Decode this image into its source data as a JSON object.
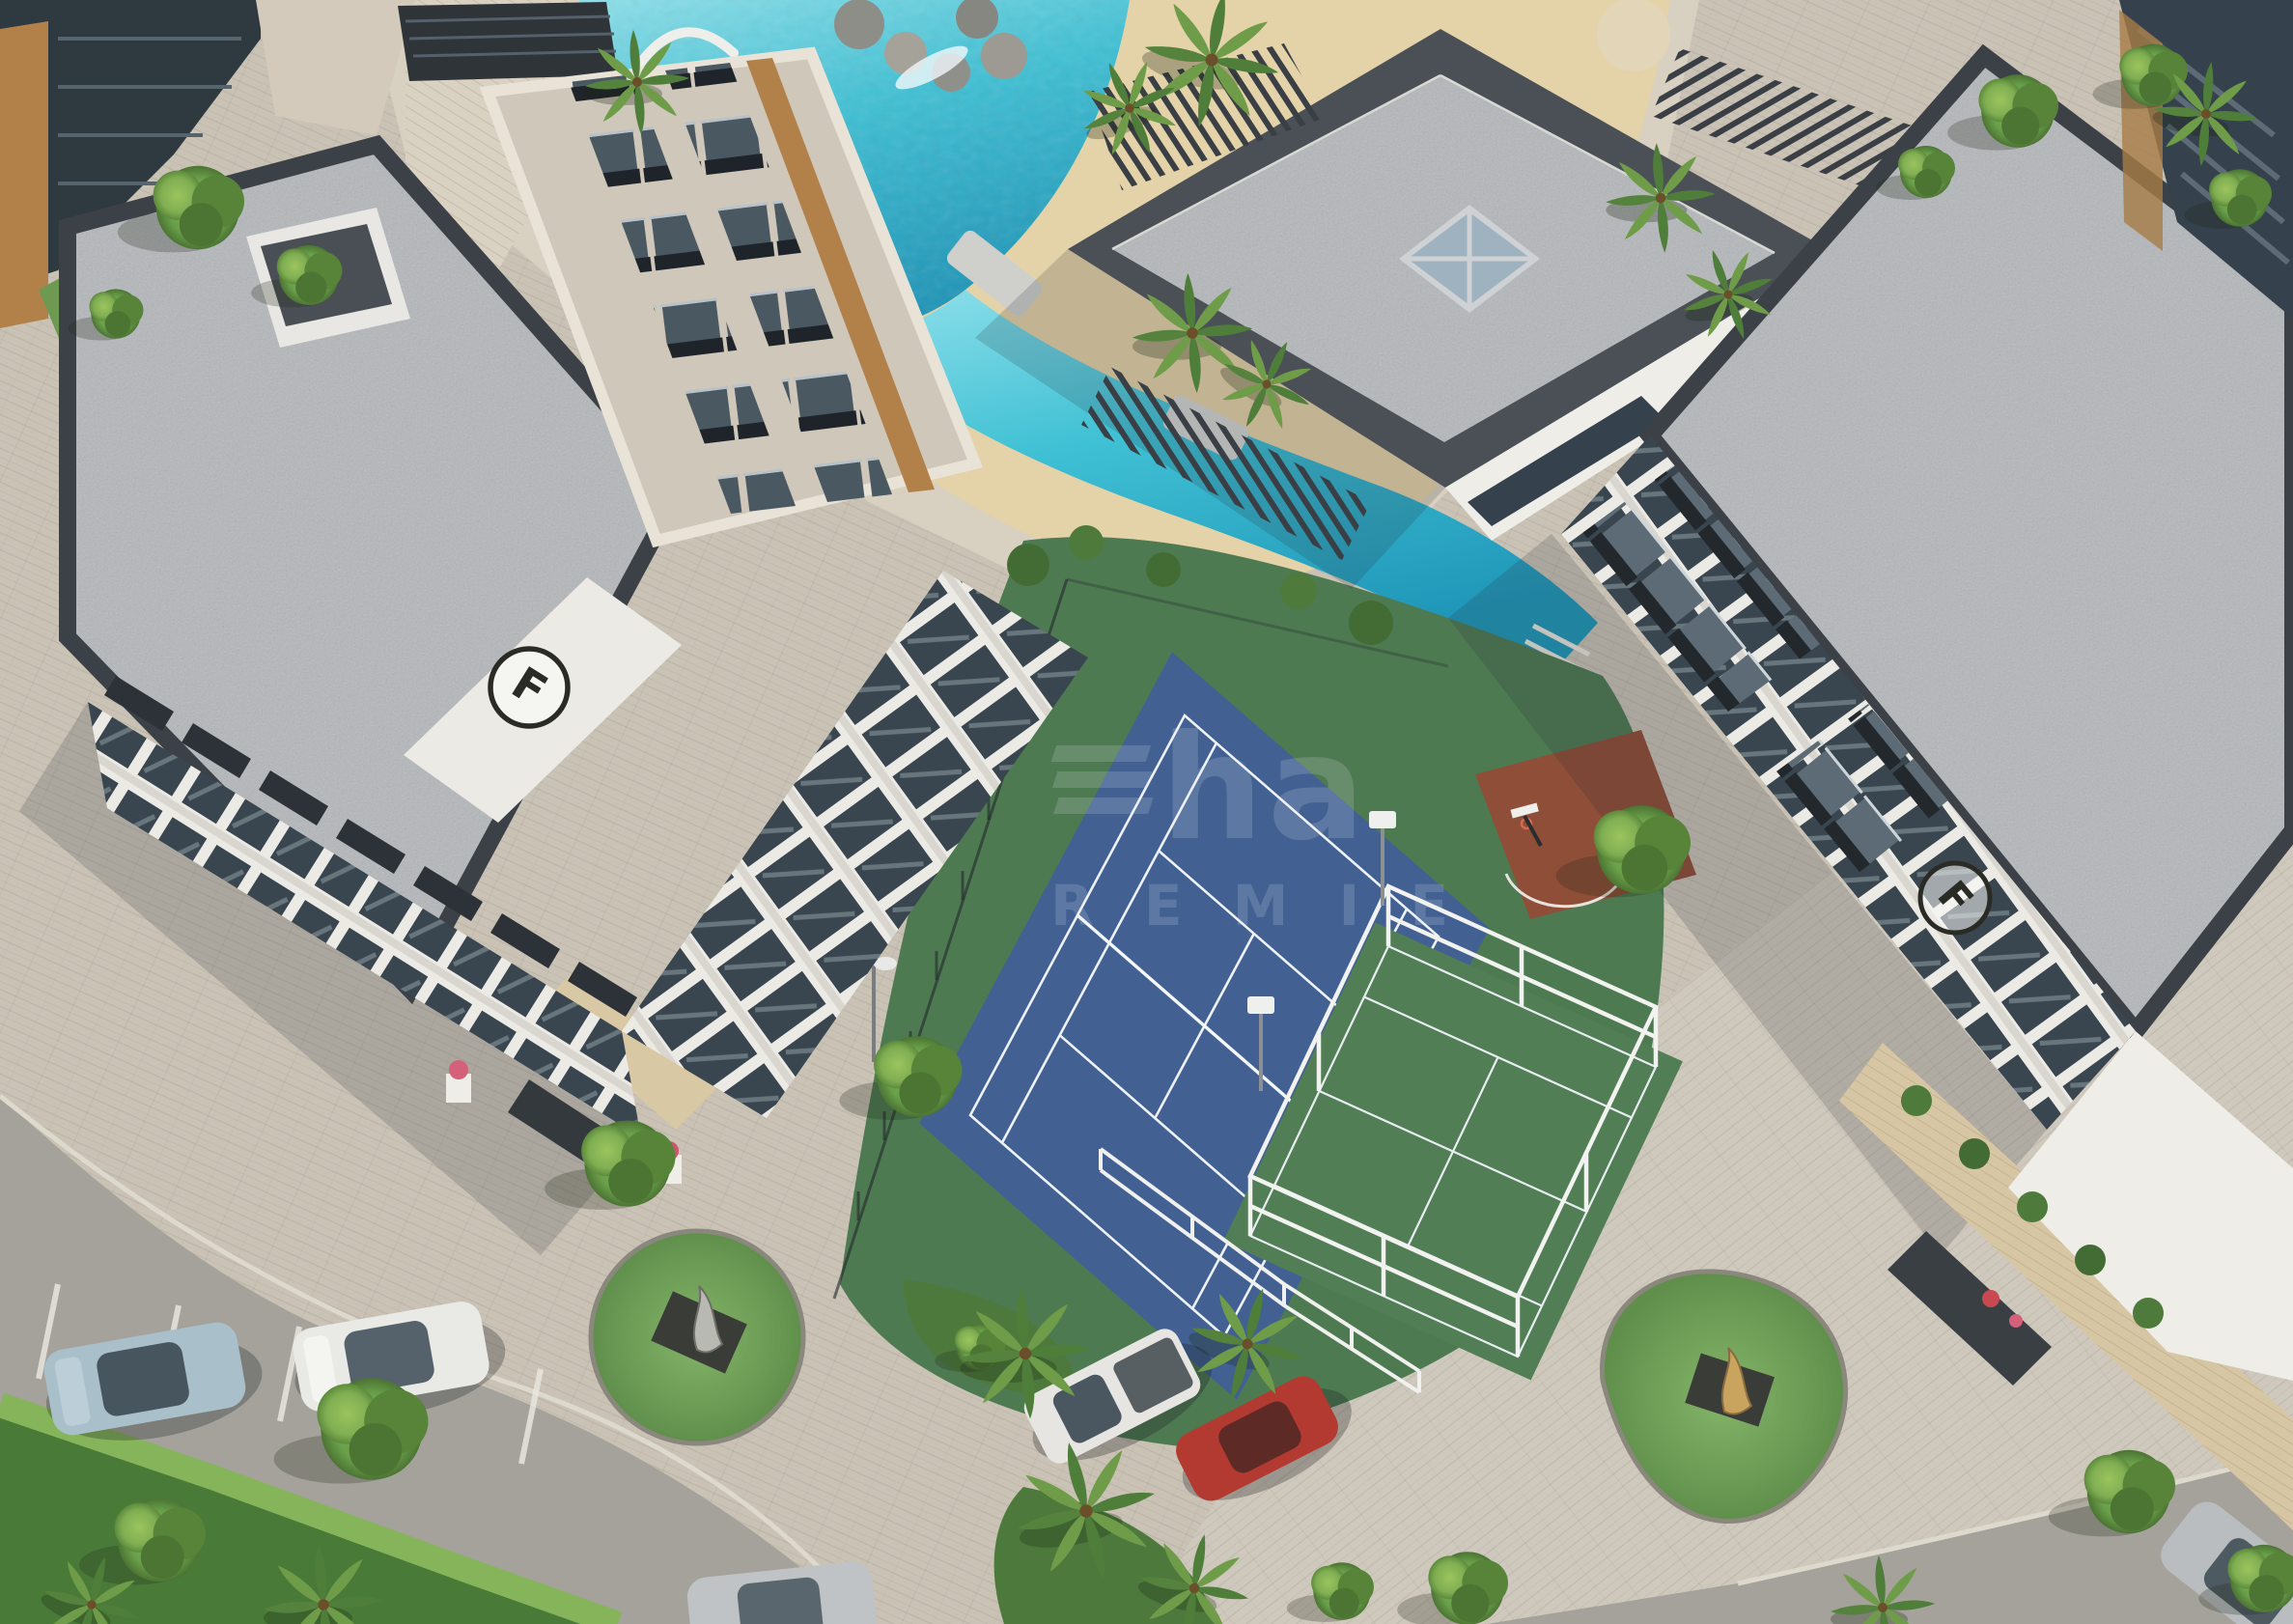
{
  "scene": {
    "description": "Aerial three-quarter view architectural rendering of a modern residential complex at daytime",
    "elements": [
      "white apartment buildings with gray gravel flat roofs and glass balconies",
      "lagoon-style swimming pool with sandy beach edge and sun loungers",
      "clubhouse pavilion with central skylight and slatted pergolas",
      "blue tennis court on dark green sports lawn",
      "padel court with white cage frame",
      "red-brown basketball half court with hoop",
      "paved roads and plazas with parked cars",
      "palm trees, hedges and two sculpture islands"
    ]
  },
  "watermark": {
    "line1_glyph": "triple-bar-logo",
    "line1": "ha",
    "line2": "R E M I E",
    "color": "#e8eef6",
    "opacity": "0.16"
  },
  "badges": {
    "left_building_monogram": "F",
    "right_building_monogram": "F"
  },
  "palette": {
    "pool_water": "#3fc0d4",
    "pool_deep": "#1f96b8",
    "sand": "#e4d2a8",
    "paver_light": "#c9c2b5",
    "paver_plaza": "#cfc8bc",
    "pool_deck": "#d8d0c0",
    "road": "#a4a29b",
    "gravel_roof": "#b4b7ba",
    "parapet": "#3c4147",
    "wall_white": "#efede8",
    "glass_dark": "#35414c",
    "wood_accent": "#b28049",
    "deck_wood": "#d7c6a4",
    "sports_lawn": "#4e7a52",
    "padel_green": "#527e55",
    "tennis_blue": "#426192",
    "court_line": "#eef2f7",
    "basketball_red": "#8f4e37",
    "tree_green": "#69a04a",
    "grass_island": "#74a65c"
  },
  "cars": [
    {
      "label": "light-blue-sedan",
      "color": "#a9bfca"
    },
    {
      "label": "white-sedan",
      "color": "#e9e9e6"
    },
    {
      "label": "white-pickup",
      "color": "#e6e5e1"
    },
    {
      "label": "red-hatchback",
      "color": "#b23a31"
    },
    {
      "label": "silver-car-bottom",
      "color": "#c0c3c5"
    },
    {
      "label": "silver-car-bottom-right",
      "color": "#b9bdc0"
    }
  ],
  "sculptures": [
    {
      "label": "chrome-figure-on-roundabout-island"
    },
    {
      "label": "gold-figure-on-teardrop-island"
    }
  ],
  "courts": [
    {
      "label": "tennis-court",
      "surface_color": "#426192"
    },
    {
      "label": "padel-court",
      "surface_color": "#527e55"
    },
    {
      "label": "basketball-half-court",
      "surface_color": "#8f4e37"
    }
  ]
}
